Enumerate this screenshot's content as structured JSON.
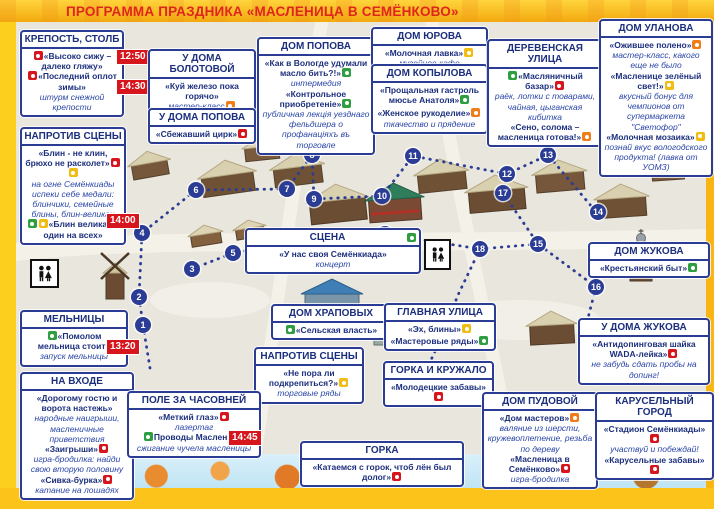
{
  "title": "ПРОГРАММА ПРАЗДНИКА «МАСЛЕНИЦА В СЕМЁНКОВО»",
  "colors": {
    "accent_blue": "#2b3c94",
    "badge_red": "#d6151c",
    "frame_yellow": "#fbc515",
    "title_red": "#e0261c",
    "icon_green": "#2f9e41",
    "icon_orange": "#ef7d1a",
    "icon_yellow": "#f0bd12"
  },
  "boxes": {
    "krepost": {
      "header": "КРЕПОСТЬ, СТОЛБ",
      "e1": "«Высоко сижу – далеко гляжу»",
      "t1": "12:50",
      "e2": "«Последний оплот зимы»",
      "t2": "14:30",
      "d2": "штурм снежной крепости"
    },
    "naprotiv1": {
      "header": "НАПРОТИВ СЦЕНЫ",
      "e1": "«Блин - не клин, брюхо не расколет»",
      "d1": "на огне Семёнкиады испеки себе медали: блинчики, семейные блины, блин-великан",
      "e2": "«Блин великан – один на всех»",
      "t2": "14:00"
    },
    "melnicy": {
      "header": "МЕЛЬНИЦЫ",
      "e1": "«Помолом мельница стоит»",
      "t1": "13:20",
      "d1": "запуск мельницы"
    },
    "vhod": {
      "header": "НА ВХОДЕ",
      "e1": "«Дорогому гостю и ворота настежь»",
      "d1": "народные наигрыши, масленичные приветствия",
      "e2": "«Заигрыши»",
      "d2": "игра-бродилка: найди свою вторую половину",
      "e3": "«Сивка-бурка»",
      "d3": "катание на лошадях"
    },
    "bolotova": {
      "header": "У ДОМА БОЛОТОВОЙ",
      "e1": "«Куй железо пока горячо»",
      "d1": "мастер-класс"
    },
    "popova_u": {
      "header": "У ДОМА ПОПОВА",
      "e1": "«Сбежавший цирк»"
    },
    "popova_dom": {
      "header": "ДОМ ПОПОВА",
      "e1": "«Как в Вологде удумали масло бить?!»",
      "d1": "интермедия",
      "e2": "«Контрольное приобретеніе»",
      "d2": "публичная лекція уезднаго фельдшера о профанаціяхъ въ торговле"
    },
    "yurova": {
      "header": "ДОМ ЮРОВА",
      "e1": "«Молочная лавка»",
      "d1": "музейное кафе"
    },
    "kopylova": {
      "header": "ДОМ КОПЫЛОВА",
      "e1": "«Прощальная гастроль мюсье Анатоля»",
      "e2": "«Женское рукоделие»",
      "d2": "ткачество и прядение"
    },
    "derevenskaya": {
      "header": "ДЕРЕВЕНСКАЯ УЛИЦА",
      "e1": "«Масляничный базар»",
      "d1": "раёк, лотки с товарами, чайная, цыганская кибитка",
      "e2": "«Сено, солома – масленица готова!»"
    },
    "ulanova": {
      "header": "ДОМ УЛАНОВА",
      "e1": "«Ожившее полено»",
      "d1": "мастер-класс, какого еще не было",
      "e2": "«Масленице зелёный свет!»",
      "d2": "вкусный бонус для чемпионов от супермаркета \"Светофор\"",
      "e3": "«Молочная мозаика»",
      "d3": "познай вкус вологодского продукта! (лавка от УОМЗ)"
    },
    "scena": {
      "header": "СЦЕНА",
      "e1": "«У нас своя Семёнкиада»",
      "d1": "концерт"
    },
    "zhukova_dom": {
      "header": "ДОМ ЖУКОВА",
      "e1": "«Крестьянский быт»"
    },
    "zhukova_u": {
      "header": "У ДОМА ЖУКОВА",
      "e1": "«Антидопинговая шайка WADA-лейка»",
      "d1": "не забудь сдать пробы на допинг!"
    },
    "hrapovyh": {
      "header": "ДОМ ХРАПОВЫХ",
      "e1": "«Сельская власть»"
    },
    "glavnaya": {
      "header": "ГЛАВНАЯ УЛИЦА",
      "e1": "«Эх, блины»",
      "e2": "«Мастеровые ряды»"
    },
    "naprotiv2": {
      "header": "НАПРОТИВ СЦЕНЫ",
      "e1": "«Не пора ли подкрепиться?»",
      "d1": "торговые ряды"
    },
    "gorka_kruzhalo": {
      "header": "ГОРКА И КРУЖАЛО",
      "e1": "«Молодецкие забавы»"
    },
    "pole": {
      "header": "ПОЛЕ ЗА ЧАСОВНЕЙ",
      "e1": "«Меткий глаз»",
      "d1": "лазертаг",
      "e2": "Проводы Масленицы",
      "t2": "14:45",
      "d2": "сжигание чучела масленицы"
    },
    "gorka": {
      "header": "ГОРКА",
      "e1": "«Катаемся с горок, чтоб лён был долог»"
    },
    "pudovoy": {
      "header": "ДОМ ПУДОВОЙ",
      "e1": "«Дом мастеров»",
      "d1": "валяние из шерсти, кружевоплетение, резьба по дереву",
      "e2": "«Масленица в Семёнково»",
      "d2": "игра-бродилка"
    },
    "karusel": {
      "header": "КАРУСЕЛЬНЫЙ ГОРОД",
      "e1": "«Стадион Семёнкиады»",
      "d1": "участвуй и побеждай!",
      "e2": "«Карусельные забавы»"
    }
  },
  "map": {
    "stops": [
      "1",
      "2",
      "3",
      "4",
      "5",
      "6",
      "7",
      "8",
      "9",
      "10",
      "11",
      "12",
      "13",
      "14",
      "15",
      "16",
      "17",
      "18",
      "19"
    ]
  }
}
